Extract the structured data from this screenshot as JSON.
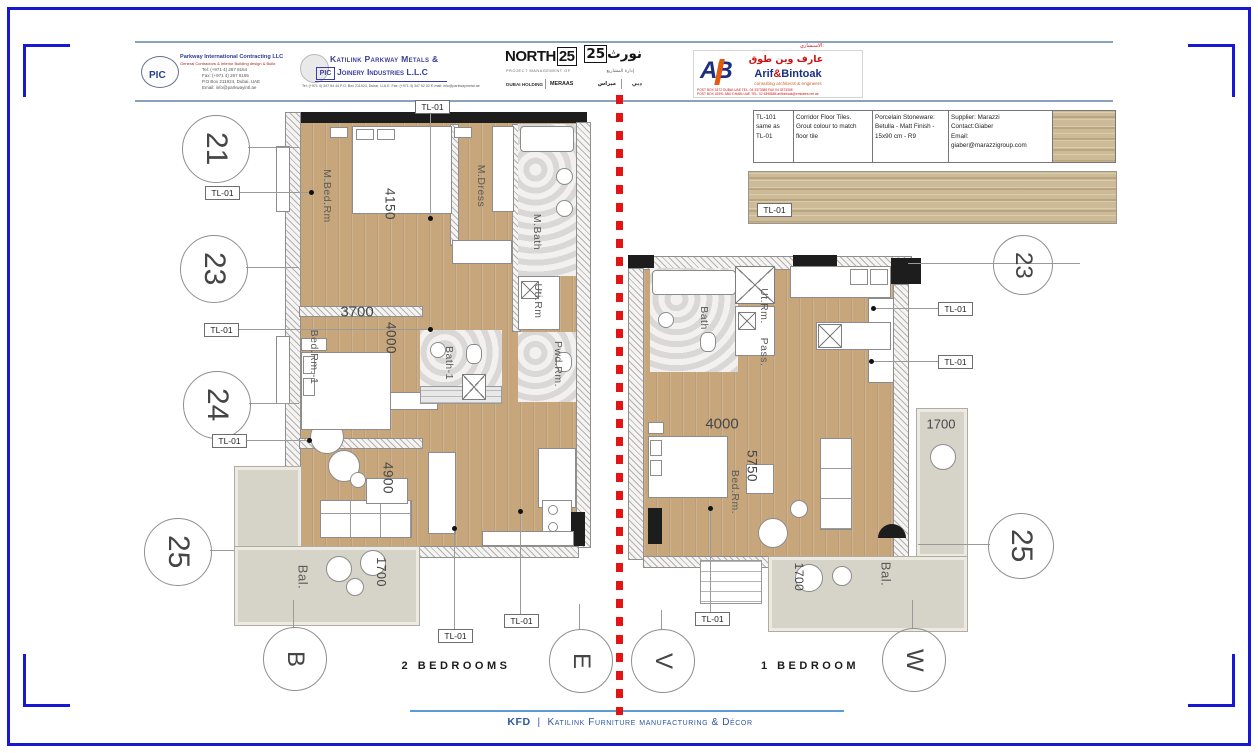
{
  "header": {
    "pic": {
      "logo_text": "PIC",
      "company": "Parkway International Contracting LLC",
      "tagline": "General Contractors & Interior Building design & Build",
      "contact_lines": [
        "Tel: (+971 4) 267 8164",
        "Fax: (+971 4) 267 8165",
        "P.O Box 211924, Dubai, UAE",
        "Email: info@parkwayintl.ae"
      ]
    },
    "katilink": {
      "logo_text": "PIC",
      "line1": "Katilink Parkway Metals &",
      "line2": "Joinery Industries L.L.C",
      "contact": "Tel: (+971 4) 347 54 44   P.O. Box 211924, Dubai, U.A.E.   Fax: (+971 4) 347 52 02   E-mail: info@parkwaymetal.ae"
    },
    "north25": {
      "name_base": "NORTH",
      "name_num": "25",
      "tagline": "PROJECT MANAGEMENT OF",
      "partner1": "DUBAI HOLDING",
      "partner2": "MERAAS",
      "arabic_name_base": "نورث",
      "arabic_name_num": "25",
      "arabic_tagline": "إدارة المشاريع",
      "arabic_partner1": "دبي",
      "arabic_partner2": "ميراس"
    },
    "arif": {
      "consultant_label": "الاستشاري:",
      "logo_text": "AB",
      "arabic_name": "عارف وين طوق",
      "latin_name_1": "Arif",
      "amp": "&",
      "latin_name_2": "Bintoak",
      "tagline": "consulting  architects  &  engineers",
      "contact_line1": "POST BOX 1872 DUBAI-UAE  TEL. 04 3373388  FAX 04 3373308",
      "contact_line2": "POST BOX 42991 ABU DHABI-UAE  TEL. 02 6398888  arifbintoak@emirates.net.ae"
    }
  },
  "tile_table": {
    "code_lines": [
      "TL-101",
      "same as",
      "TL-01"
    ],
    "desc_lines": [
      "Corridor Floor Tiles.",
      "Grout colour to match",
      "floor tile"
    ],
    "spec_lines": [
      "Porcelain Stoneware:",
      "Betulla - Matt Finish -",
      "15x90 cm  - R9"
    ],
    "supplier_lines": [
      "Supplier: Marazzi",
      "Contact:Giaber",
      "Email:",
      "giaber@marazzigroup.com"
    ]
  },
  "tag_label": "TL-01",
  "plans": {
    "left": {
      "title": "2 BEDROOMS",
      "rooms": {
        "mbed": "M.Bed.Rm",
        "mdress": "M.Dress",
        "mbath": "M.Bath",
        "utrm": "Uti.Rm",
        "pwd": "Pwd.Rm.",
        "bed1": "Bed.Rm.-1",
        "bath1": "Bath-1",
        "bal": "Bal."
      },
      "dims": {
        "d4150": "4150",
        "d3700": "3700",
        "d4000": "4000",
        "d4900": "4900",
        "d1700": "1700"
      }
    },
    "right": {
      "title": "1 BEDROOM",
      "rooms": {
        "bath": "Bath",
        "utrm": "Ut.Rm.",
        "pass": "Pass.",
        "bed": "Bed.Rm.",
        "bal": "Bal."
      },
      "dims": {
        "d4000": "4000",
        "d5750": "5750",
        "d1700a": "1700",
        "d1700b": "1700"
      }
    }
  },
  "grid": {
    "left": [
      "21",
      "23",
      "24",
      "25"
    ],
    "right": [
      "23",
      "25"
    ],
    "bottom": [
      "B",
      "E",
      "V",
      "W"
    ]
  },
  "footer": {
    "brand": "KFD",
    "sep": "|",
    "name": "Katilink Furniture manufacturing & Décor"
  }
}
